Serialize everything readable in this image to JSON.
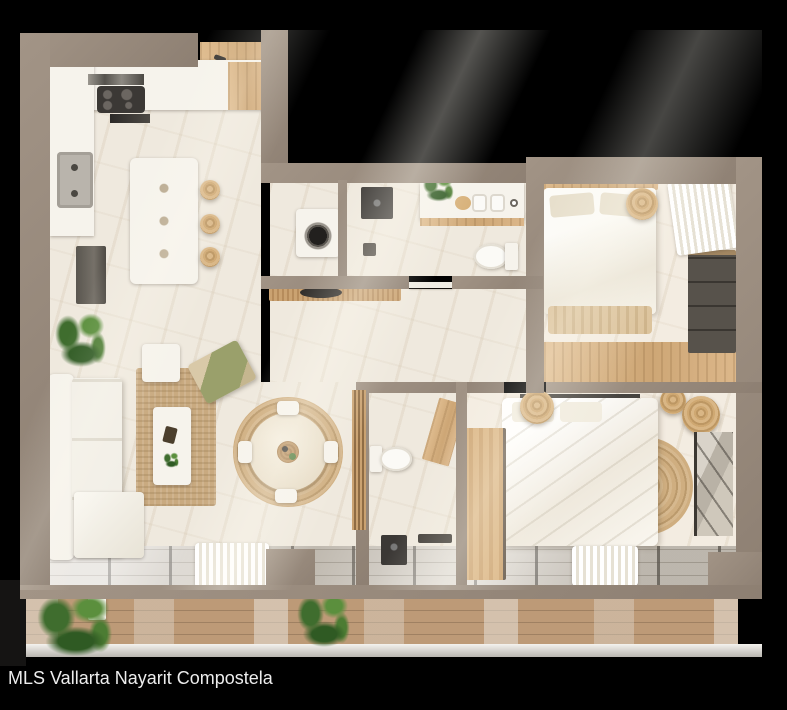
{
  "image_type": "3d-rendered apartment floor plan on black background",
  "caption": "MLS Vallarta Nayarit Compostela",
  "colors": {
    "background": "#000000",
    "wall": "#95877a",
    "wall-dark": "#7e7165",
    "floor": "#efe9de",
    "floor-vein": "#d9cbb6",
    "wood": "#d7b285",
    "deck": "#bd9a77",
    "white-furniture": "#f6f3ec",
    "dark-appliance": "#3b3835",
    "plant-green": "#4e7a3a",
    "rattan": "#cfae7e",
    "glass": "#d6d0c7",
    "caption-text": "#ededed"
  },
  "regions": [
    {
      "name": "kitchen"
    },
    {
      "name": "entry"
    },
    {
      "name": "living-room"
    },
    {
      "name": "dining-area"
    },
    {
      "name": "laundry-closet"
    },
    {
      "name": "bathroom-1"
    },
    {
      "name": "hallway"
    },
    {
      "name": "bedroom-1"
    },
    {
      "name": "bathroom-2"
    },
    {
      "name": "bedroom-2"
    },
    {
      "name": "balcony"
    }
  ]
}
